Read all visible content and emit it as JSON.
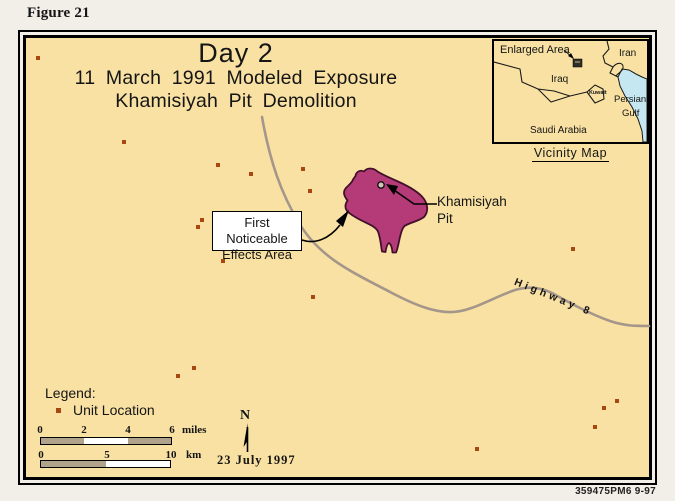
{
  "figure_label": "Figure 21",
  "title": {
    "line1": "Day 2",
    "line2": "11 March 1991 Modeled Exposure",
    "line3": "Khamisiyah Pit Demolition"
  },
  "annotations": {
    "effects_area_line1": "First Noticeable",
    "effects_area_line2": "Effects Area",
    "pit_line1": "Khamisiyah",
    "pit_line2": "Pit",
    "highway": "Highway 8"
  },
  "vicinity": {
    "title": "Vicinity Map",
    "enlarged_area": "Enlarged Area",
    "iran": "Iran",
    "iraq": "Iraq",
    "kuwait": "Kuwait",
    "persian": "Persian",
    "gulf": "Gulf",
    "saudi_arabia": "Saudi Arabia"
  },
  "legend": {
    "heading": "Legend:",
    "unit_location": "Unit Location"
  },
  "scalebar": {
    "miles": {
      "ticks": [
        "0",
        "2",
        "4",
        "6"
      ],
      "unit": "miles"
    },
    "km": {
      "ticks": [
        "0",
        "5",
        "10"
      ],
      "unit": "km"
    }
  },
  "compass_n": "N",
  "date_label": "23 July 1997",
  "footer_code": "359475PM6  9-97",
  "unit_locations": [
    [
      36,
      56
    ],
    [
      122,
      140
    ],
    [
      216,
      163
    ],
    [
      249,
      172
    ],
    [
      301,
      167
    ],
    [
      308,
      189
    ],
    [
      200,
      218
    ],
    [
      196,
      225
    ],
    [
      221,
      259
    ],
    [
      311,
      295
    ],
    [
      571,
      247
    ],
    [
      176,
      374
    ],
    [
      192,
      366
    ],
    [
      615,
      399
    ],
    [
      602,
      406
    ],
    [
      593,
      425
    ],
    [
      475,
      447
    ]
  ],
  "colors": {
    "page_bg": "#f2efe8",
    "map_bg": "#f8e1a2",
    "blob_fill": "#b43a78",
    "blob_stroke": "#42102a",
    "road": "#a4968a",
    "gulf_fill": "#c4e7f2",
    "unit_dot": "#a8470f",
    "label_box_bg": "#ffffff",
    "frame": "#000000",
    "ink": "#151515"
  }
}
